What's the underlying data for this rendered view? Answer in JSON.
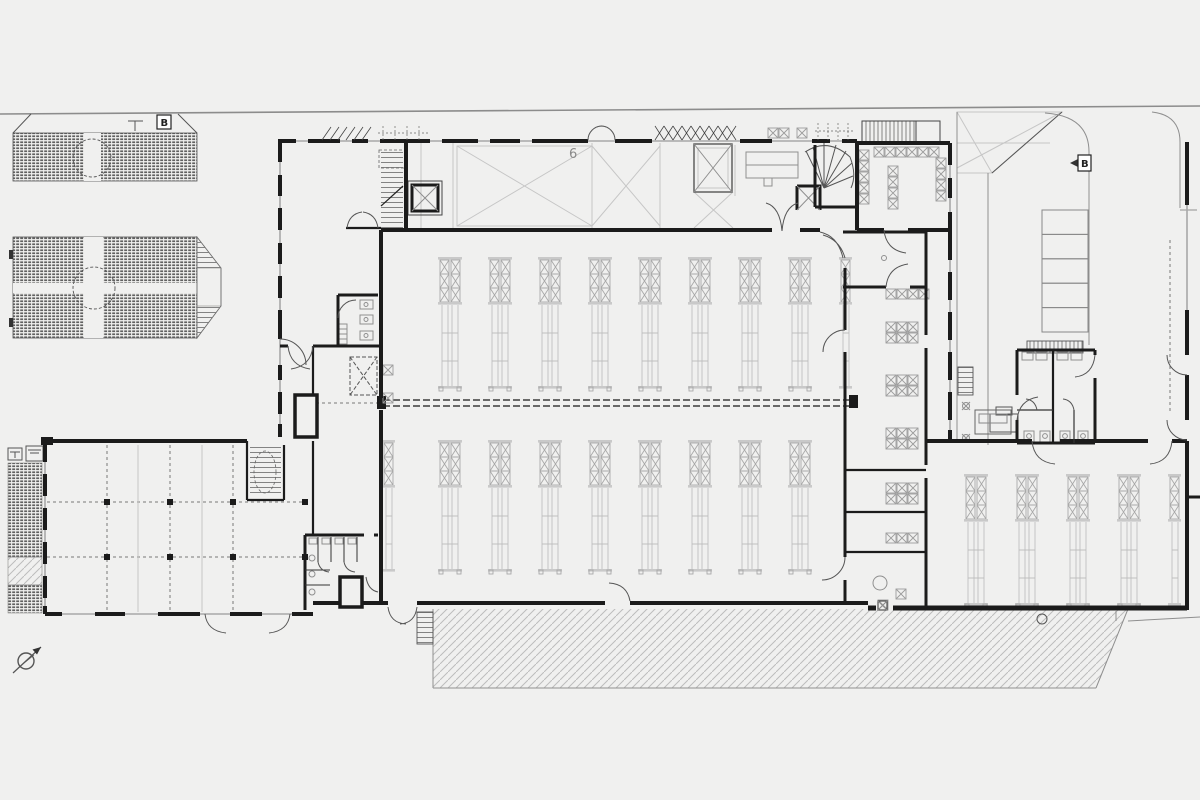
{
  "drawing": {
    "type": "architectural-floor-plan",
    "background_color": "#f0f0ef",
    "wall_color": "#1b1b1b",
    "glazing_color": "#a8a8a8",
    "detail_color": "#8f8f8f",
    "light_line_color": "#c6c6c6",
    "rack_color": "#b5b5b5",
    "site_line_color": "#8c8c8c"
  },
  "labels": {
    "hall_number": "6",
    "site_marker_north": "B",
    "site_marker_driveway": "B"
  },
  "racks": {
    "rows": [
      {
        "name": "upper-hall-rack-row",
        "symbol": "rack",
        "y": 257,
        "xs": [
          437,
          487,
          537,
          587,
          637,
          687,
          737,
          787
        ]
      },
      {
        "name": "upper-hall-wall-rack",
        "symbol": "rack-half",
        "y": 257,
        "xs": [
          839
        ]
      },
      {
        "name": "lower-hall-rack-row",
        "symbol": "rack",
        "y": 440,
        "xs": [
          437,
          487,
          537,
          587,
          637,
          687,
          737,
          787
        ]
      },
      {
        "name": "lower-hall-wall-rack",
        "symbol": "rack-half",
        "y": 440,
        "xs": [
          382
        ]
      },
      {
        "name": "right-hall-rack-row",
        "symbol": "rack",
        "y": 474,
        "xs": [
          963,
          1014,
          1065,
          1116
        ]
      },
      {
        "name": "right-hall-wall-rack",
        "symbol": "rack-half",
        "y": 474,
        "xs": [
          1168
        ]
      }
    ]
  },
  "parking": {
    "x": 1042,
    "y": 210,
    "cell_width": 46,
    "cell_height": 24.4,
    "count": 5
  }
}
